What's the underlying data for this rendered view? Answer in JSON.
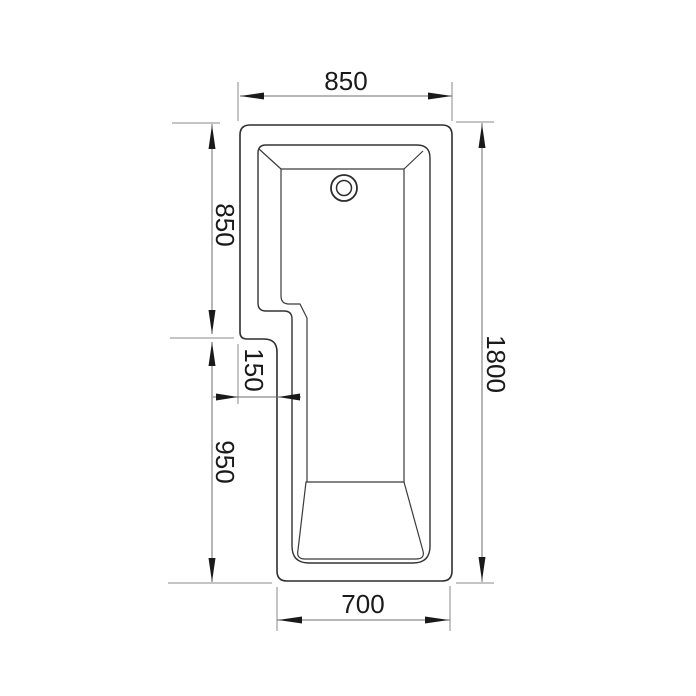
{
  "drawing": {
    "description": "L-shaped shower bath technical plan drawing",
    "dimensions": {
      "top_width": "850",
      "upper_left_height": "850",
      "step_width": "150",
      "lower_left_height": "950",
      "overall_height": "1800",
      "bottom_width": "700"
    },
    "colors": {
      "background": "#ffffff",
      "bath_outline": "#2e2e2e",
      "dimension_lines": "#6e6e6e",
      "extension_lines": "#8a8a8a",
      "text_and_arrows": "#1a1a1a"
    }
  }
}
